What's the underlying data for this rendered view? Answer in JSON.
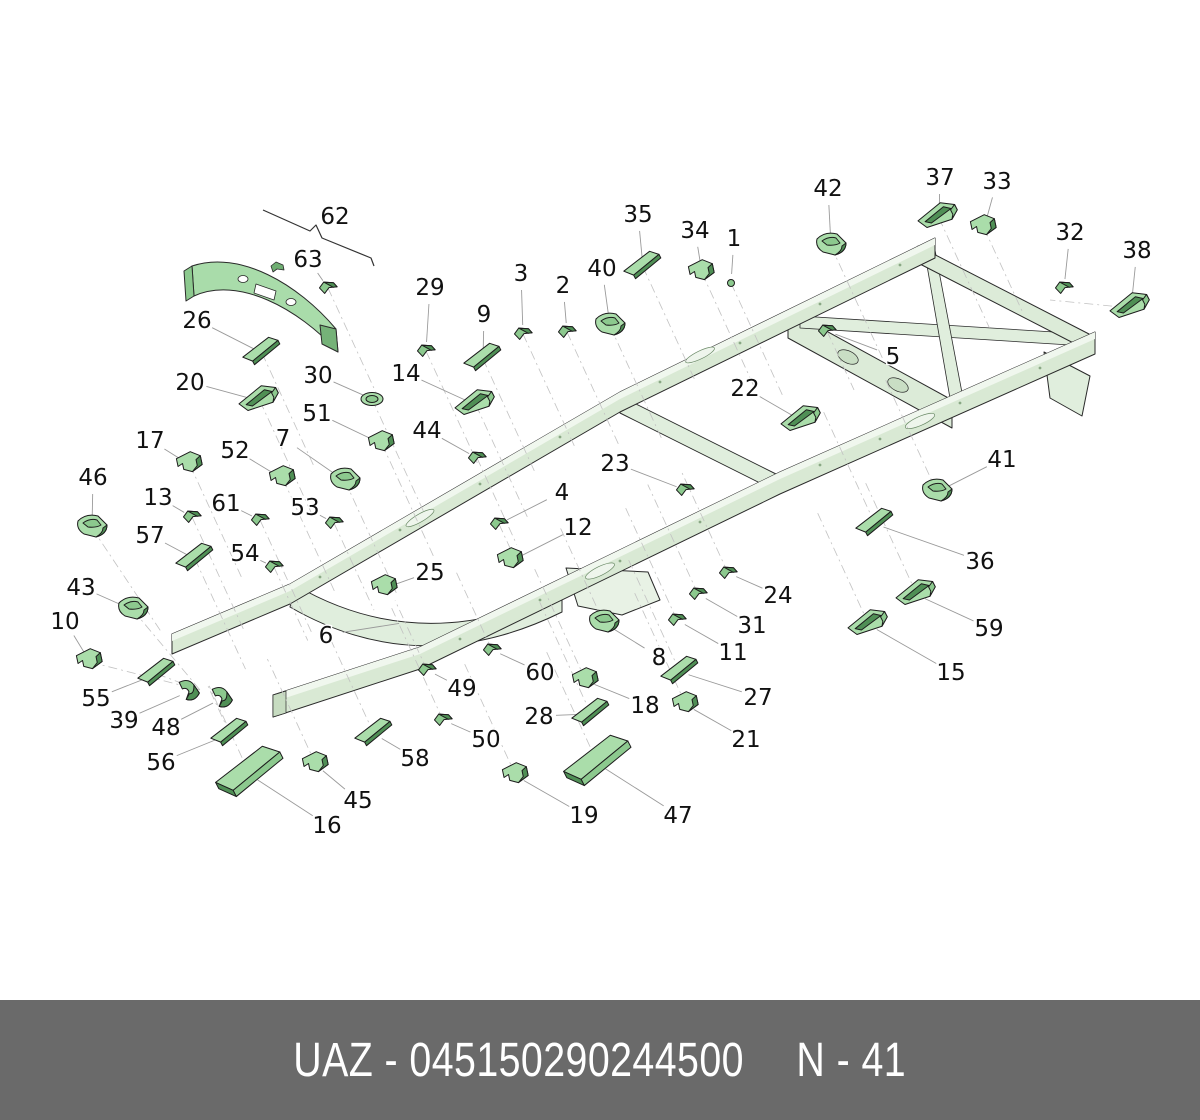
{
  "palette": {
    "part_light": "#aaddaa",
    "part_mid": "#8cc98e",
    "part_dark": "#4f8f55",
    "frame_fill": "#d9e9d4",
    "frame_top": "#f0f7ee",
    "outline": "#1c1c1c",
    "leader": "#9a9a9a",
    "axis": "#c2c2c2",
    "label_color": "#111111",
    "footer_bg": "#6a6a6a",
    "footer_text": "#ffffff"
  },
  "footer": {
    "code": "UAZ - 045150290244500",
    "page": "N - 41"
  },
  "diagram": {
    "callouts": [
      {
        "n": "1",
        "lx": 734,
        "ly": 238,
        "tx": 731,
        "ty": 283,
        "g": "bolt"
      },
      {
        "n": "2",
        "lx": 563,
        "ly": 285,
        "tx": 567,
        "ty": 332,
        "g": "clip"
      },
      {
        "n": "3",
        "lx": 521,
        "ly": 273,
        "tx": 523,
        "ty": 334,
        "g": "clip"
      },
      {
        "n": "4",
        "lx": 562,
        "ly": 492,
        "tx": 499,
        "ty": 524,
        "g": "clip"
      },
      {
        "n": "5",
        "lx": 893,
        "ly": 356,
        "tx": 827,
        "ty": 331,
        "g": "clip"
      },
      {
        "n": "6",
        "lx": 326,
        "ly": 635,
        "tx": 408,
        "ty": 622,
        "g": "none"
      },
      {
        "n": "7",
        "lx": 283,
        "ly": 438,
        "tx": 345,
        "ty": 481,
        "g": "mount"
      },
      {
        "n": "8",
        "lx": 659,
        "ly": 657,
        "tx": 604,
        "ty": 623,
        "g": "mount"
      },
      {
        "n": "9",
        "lx": 484,
        "ly": 314,
        "tx": 483,
        "ty": 359,
        "g": "plate"
      },
      {
        "n": "10",
        "lx": 65,
        "ly": 621,
        "tx": 90,
        "ty": 662,
        "g": "bracket"
      },
      {
        "n": "11",
        "lx": 733,
        "ly": 652,
        "tx": 677,
        "ty": 620,
        "g": "clip"
      },
      {
        "n": "12",
        "lx": 578,
        "ly": 527,
        "tx": 511,
        "ty": 561,
        "g": "bracket"
      },
      {
        "n": "13",
        "lx": 158,
        "ly": 497,
        "tx": 192,
        "ty": 517,
        "g": "clip"
      },
      {
        "n": "14",
        "lx": 406,
        "ly": 373,
        "tx": 476,
        "ty": 405,
        "g": "channel"
      },
      {
        "n": "15",
        "lx": 951,
        "ly": 672,
        "tx": 869,
        "ty": 625,
        "g": "channel"
      },
      {
        "n": "16",
        "lx": 327,
        "ly": 825,
        "tx": 250,
        "ty": 775,
        "g": "lplate"
      },
      {
        "n": "17",
        "lx": 150,
        "ly": 440,
        "tx": 190,
        "ty": 465,
        "g": "bracket"
      },
      {
        "n": "18",
        "lx": 645,
        "ly": 705,
        "tx": 586,
        "ty": 681,
        "g": "bracket"
      },
      {
        "n": "19",
        "lx": 584,
        "ly": 815,
        "tx": 516,
        "ty": 776,
        "g": "bracket"
      },
      {
        "n": "20",
        "lx": 190,
        "ly": 382,
        "tx": 260,
        "ty": 401,
        "g": "channel"
      },
      {
        "n": "21",
        "lx": 746,
        "ly": 739,
        "tx": 686,
        "ty": 705,
        "g": "bracket"
      },
      {
        "n": "22",
        "lx": 745,
        "ly": 388,
        "tx": 802,
        "ty": 421,
        "g": "channel"
      },
      {
        "n": "23",
        "lx": 615,
        "ly": 463,
        "tx": 685,
        "ty": 490,
        "g": "clip"
      },
      {
        "n": "24",
        "lx": 778,
        "ly": 595,
        "tx": 728,
        "ty": 573,
        "g": "clip"
      },
      {
        "n": "25",
        "lx": 430,
        "ly": 572,
        "tx": 385,
        "ty": 588,
        "g": "bracket"
      },
      {
        "n": "26",
        "lx": 197,
        "ly": 320,
        "tx": 262,
        "ty": 353,
        "g": "plate"
      },
      {
        "n": "27",
        "lx": 758,
        "ly": 697,
        "tx": 680,
        "ty": 672,
        "g": "plate"
      },
      {
        "n": "28",
        "lx": 539,
        "ly": 716,
        "tx": 591,
        "ty": 714,
        "g": "plate"
      },
      {
        "n": "29",
        "lx": 430,
        "ly": 287,
        "tx": 426,
        "ty": 351,
        "g": "clip"
      },
      {
        "n": "30",
        "lx": 318,
        "ly": 375,
        "tx": 372,
        "ty": 399,
        "g": "cup"
      },
      {
        "n": "31",
        "lx": 752,
        "ly": 625,
        "tx": 698,
        "ty": 594,
        "g": "clip"
      },
      {
        "n": "32",
        "lx": 1070,
        "ly": 232,
        "tx": 1064,
        "ty": 288,
        "g": "clip"
      },
      {
        "n": "33",
        "lx": 997,
        "ly": 181,
        "tx": 984,
        "ty": 228,
        "g": "bracket"
      },
      {
        "n": "34",
        "lx": 695,
        "ly": 230,
        "tx": 702,
        "ty": 273,
        "g": "bracket"
      },
      {
        "n": "35",
        "lx": 638,
        "ly": 214,
        "tx": 643,
        "ty": 267,
        "g": "plate"
      },
      {
        "n": "36",
        "lx": 980,
        "ly": 561,
        "tx": 875,
        "ty": 524,
        "g": "plate"
      },
      {
        "n": "37",
        "lx": 940,
        "ly": 177,
        "tx": 939,
        "ty": 218,
        "g": "channel"
      },
      {
        "n": "38",
        "lx": 1137,
        "ly": 250,
        "tx": 1131,
        "ty": 308,
        "g": "channel"
      },
      {
        "n": "39",
        "lx": 124,
        "ly": 720,
        "tx": 188,
        "ty": 692,
        "g": "hook"
      },
      {
        "n": "40",
        "lx": 602,
        "ly": 268,
        "tx": 610,
        "ty": 326,
        "g": "mount"
      },
      {
        "n": "41",
        "lx": 1002,
        "ly": 459,
        "tx": 937,
        "ty": 492,
        "g": "mount"
      },
      {
        "n": "42",
        "lx": 828,
        "ly": 188,
        "tx": 831,
        "ty": 246,
        "g": "mount"
      },
      {
        "n": "43",
        "lx": 81,
        "ly": 587,
        "tx": 133,
        "ty": 610,
        "g": "mount"
      },
      {
        "n": "44",
        "lx": 427,
        "ly": 430,
        "tx": 477,
        "ty": 458,
        "g": "clip"
      },
      {
        "n": "45",
        "lx": 358,
        "ly": 800,
        "tx": 316,
        "ty": 765,
        "g": "bracket"
      },
      {
        "n": "46",
        "lx": 93,
        "ly": 477,
        "tx": 92,
        "ty": 528,
        "g": "mount"
      },
      {
        "n": "47",
        "lx": 678,
        "ly": 815,
        "tx": 598,
        "ty": 764,
        "g": "lplate"
      },
      {
        "n": "48",
        "lx": 166,
        "ly": 727,
        "tx": 221,
        "ty": 699,
        "g": "hook"
      },
      {
        "n": "49",
        "lx": 462,
        "ly": 688,
        "tx": 427,
        "ty": 670,
        "g": "clip"
      },
      {
        "n": "50",
        "lx": 486,
        "ly": 739,
        "tx": 443,
        "ty": 720,
        "g": "clip"
      },
      {
        "n": "51",
        "lx": 317,
        "ly": 413,
        "tx": 382,
        "ty": 444,
        "g": "bracket"
      },
      {
        "n": "52",
        "lx": 235,
        "ly": 450,
        "tx": 283,
        "ty": 479,
        "g": "bracket"
      },
      {
        "n": "53",
        "lx": 305,
        "ly": 507,
        "tx": 334,
        "ty": 523,
        "g": "clip"
      },
      {
        "n": "54",
        "lx": 245,
        "ly": 553,
        "tx": 274,
        "ty": 567,
        "g": "clip"
      },
      {
        "n": "55",
        "lx": 96,
        "ly": 698,
        "tx": 157,
        "ty": 674,
        "g": "plate"
      },
      {
        "n": "56",
        "lx": 161,
        "ly": 762,
        "tx": 230,
        "ty": 734,
        "g": "plate"
      },
      {
        "n": "57",
        "lx": 150,
        "ly": 535,
        "tx": 195,
        "ty": 559,
        "g": "plate"
      },
      {
        "n": "58",
        "lx": 415,
        "ly": 758,
        "tx": 374,
        "ty": 734,
        "g": "plate"
      },
      {
        "n": "59",
        "lx": 989,
        "ly": 628,
        "tx": 917,
        "ty": 595,
        "g": "channel"
      },
      {
        "n": "60",
        "lx": 540,
        "ly": 672,
        "tx": 492,
        "ty": 650,
        "g": "clip"
      },
      {
        "n": "61",
        "lx": 226,
        "ly": 503,
        "tx": 260,
        "ty": 520,
        "g": "clip"
      },
      {
        "n": "62",
        "lx": 335,
        "ly": 216,
        "tx": null,
        "ty": null,
        "g": "none"
      },
      {
        "n": "63",
        "lx": 308,
        "ly": 259,
        "tx": 328,
        "ty": 288,
        "g": "clip"
      }
    ]
  }
}
